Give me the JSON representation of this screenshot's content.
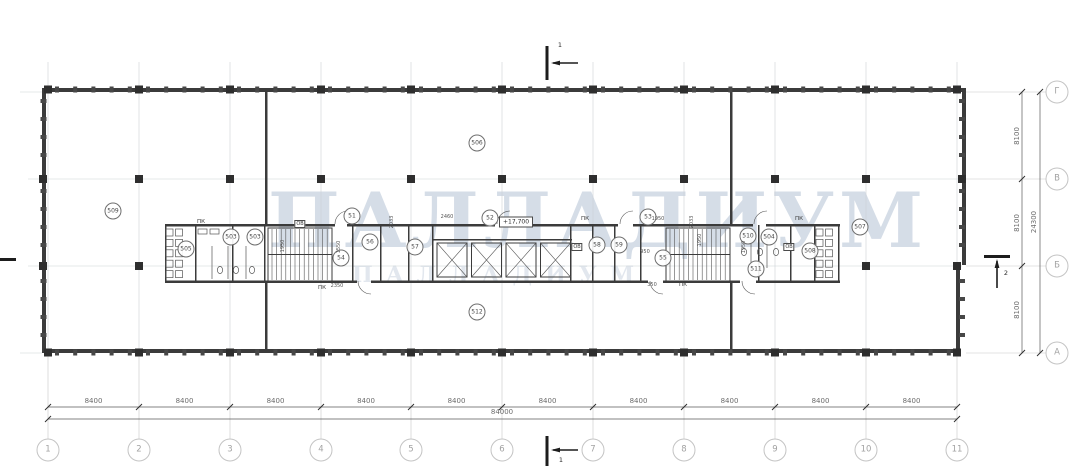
{
  "drawing": {
    "watermark": {
      "line1": "ПАЛЛАДИУМ",
      "line2": "ПАЛЛАДИУМ"
    },
    "section_markers": {
      "top": "1",
      "bottom": "1",
      "right": "2"
    },
    "elevation_box": {
      "text": "+17,700",
      "x": 500,
      "y": 222
    },
    "axes": {
      "cols": {
        "labels": [
          "1",
          "2",
          "3",
          "4",
          "5",
          "6",
          "7",
          "8",
          "9",
          "10",
          "11"
        ],
        "dims": [
          "8400",
          "8400",
          "8400",
          "8400",
          "8400",
          "8400",
          "8400",
          "8400",
          "8400",
          "8400"
        ],
        "total": "84000"
      },
      "rows": {
        "labels": [
          "Г",
          "В",
          "Б",
          "А"
        ],
        "dims": [
          "8100",
          "8100",
          "8100"
        ],
        "total": "24300"
      }
    },
    "rooms": [
      {
        "label": "509",
        "x": 113,
        "y": 211
      },
      {
        "label": "505",
        "x": 186,
        "y": 249
      },
      {
        "label": "503",
        "x": 231,
        "y": 237
      },
      {
        "label": "503",
        "x": 255,
        "y": 237
      },
      {
        "label": "51",
        "x": 352,
        "y": 216
      },
      {
        "label": "56",
        "x": 370,
        "y": 242
      },
      {
        "label": "54",
        "x": 341,
        "y": 258
      },
      {
        "label": "57",
        "x": 415,
        "y": 247
      },
      {
        "label": "52",
        "x": 490,
        "y": 218
      },
      {
        "label": "58",
        "x": 597,
        "y": 245
      },
      {
        "label": "59",
        "x": 619,
        "y": 245
      },
      {
        "label": "53",
        "x": 648,
        "y": 217
      },
      {
        "label": "55",
        "x": 663,
        "y": 258
      },
      {
        "label": "510",
        "x": 748,
        "y": 236
      },
      {
        "label": "504",
        "x": 769,
        "y": 237
      },
      {
        "label": "511",
        "x": 756,
        "y": 269
      },
      {
        "label": "508",
        "x": 810,
        "y": 251
      },
      {
        "label": "507",
        "x": 860,
        "y": 227
      },
      {
        "label": "506",
        "x": 477,
        "y": 143
      },
      {
        "label": "512",
        "x": 477,
        "y": 312
      }
    ],
    "annotations": [
      {
        "text": "ПК",
        "x": 201,
        "y": 222,
        "kind": "ann"
      },
      {
        "text": "ПК",
        "x": 322,
        "y": 288,
        "kind": "ann"
      },
      {
        "text": "ПК",
        "x": 585,
        "y": 219,
        "kind": "ann"
      },
      {
        "text": "ПК",
        "x": 683,
        "y": 285,
        "kind": "ann"
      },
      {
        "text": "ПК",
        "x": 799,
        "y": 219,
        "kind": "ann"
      },
      {
        "text": "ОВ",
        "x": 300,
        "y": 224,
        "kind": "box"
      },
      {
        "text": "ОВ",
        "x": 577,
        "y": 247,
        "kind": "box"
      },
      {
        "text": "ОВ",
        "x": 789,
        "y": 247,
        "kind": "box"
      },
      {
        "text": "1950",
        "x": 283,
        "y": 246,
        "kind": "dimv"
      },
      {
        "text": "1550",
        "x": 339,
        "y": 247,
        "kind": "dimv"
      },
      {
        "text": "2350",
        "x": 337,
        "y": 286,
        "kind": "dimh"
      },
      {
        "text": "2033",
        "x": 392,
        "y": 222,
        "kind": "dimv"
      },
      {
        "text": "2460",
        "x": 447,
        "y": 217,
        "kind": "dimh"
      },
      {
        "text": "1950",
        "x": 658,
        "y": 219,
        "kind": "dimh"
      },
      {
        "text": "950",
        "x": 645,
        "y": 252,
        "kind": "dimh"
      },
      {
        "text": "2033",
        "x": 692,
        "y": 222,
        "kind": "dimv"
      },
      {
        "text": "1950",
        "x": 700,
        "y": 240,
        "kind": "dimv"
      },
      {
        "text": "350",
        "x": 652,
        "y": 285,
        "kind": "dimh"
      },
      {
        "text": "1950",
        "x": 744,
        "y": 247,
        "kind": "dimv"
      }
    ],
    "colors": {
      "line": "#3b3b3b",
      "grid": "#ccd1d5",
      "dim_text": "#6b6b6b",
      "axis_bubble": "#c4c4c4",
      "watermark": "#b4c2d4"
    }
  }
}
